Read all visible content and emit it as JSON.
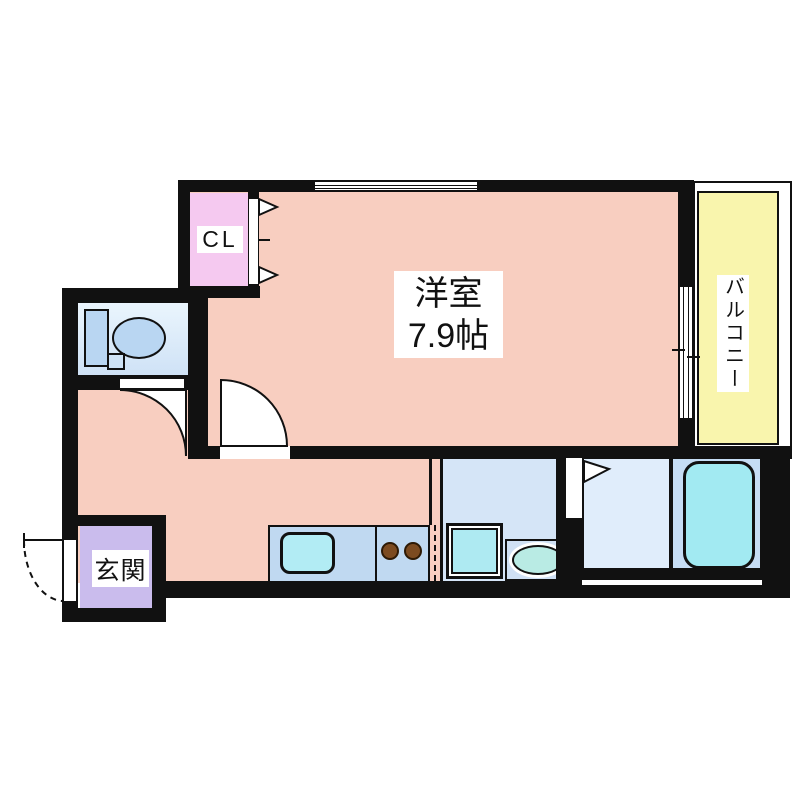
{
  "floorplan": {
    "rooms": {
      "main_room": {
        "name": "洋室",
        "size": "7.9帖",
        "color": "#f8cec0"
      },
      "closet": {
        "label": "CL",
        "color": "#f5c9f0"
      },
      "balcony": {
        "label": "バルコニー",
        "color": "#f9f5ad"
      },
      "entrance": {
        "label": "玄関",
        "color": "#cabced"
      },
      "toilet": {
        "color": "#d8eafa"
      },
      "kitchen_counter": {
        "color": "#c0d9f1"
      },
      "washroom": {
        "color": "#d5e5f7"
      },
      "bathroom": {
        "color": "#e0edfb"
      }
    },
    "fixtures": [
      "toilet",
      "kitchen-sink",
      "gas-stove-2-burner",
      "washing-machine",
      "washbasin",
      "bathtub"
    ],
    "wall_color": "#111111",
    "background": "#ffffff"
  }
}
